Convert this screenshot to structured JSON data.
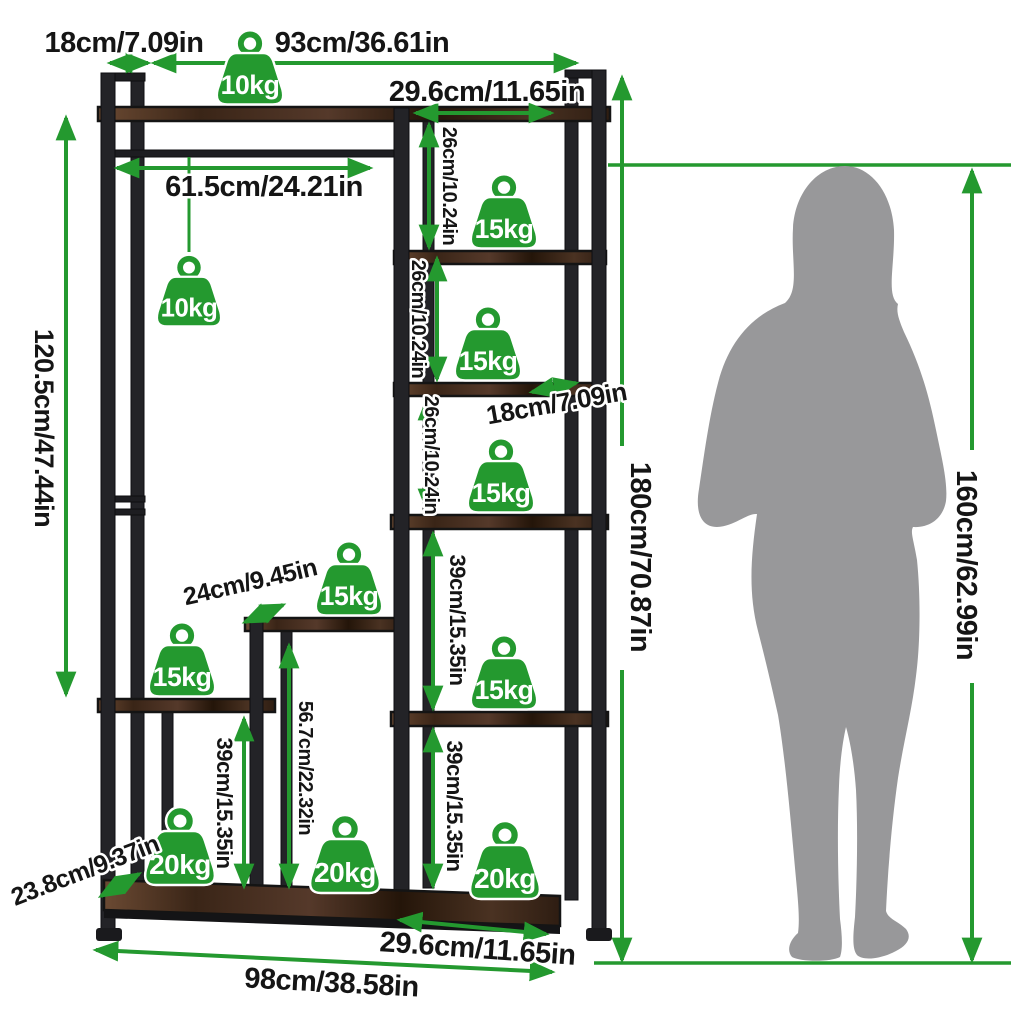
{
  "diagram": {
    "colors": {
      "accent_green": "#24992f",
      "frame_metal": "#232327",
      "shelf_wood": "#4a3322",
      "silhouette_gray": "#98989a",
      "label_text": "#151515",
      "background": "#ffffff"
    },
    "dims": {
      "top_side_width": "18cm/7.09in",
      "top_main_width": "93cm/36.61in",
      "top_shelf_depth": "29.6cm/11.65in",
      "hanging_rod_length": "61.5cm/24.21in",
      "hanging_area_height": "120.5cm/47.44in",
      "shelf_gap_top": "26cm/10.24in",
      "shelf_gap_mid": "26cm/10.24in",
      "shelf_gap_lower": "26cm/10.24in",
      "upper_shelf_depth": "18cm/7.09in",
      "total_height": "180cm/70.87in",
      "person_height": "160cm/62.99in",
      "right_gap_upper": "39cm/15.35in",
      "right_gap_lower": "39cm/15.35in",
      "left_shelf_gap": "39cm/15.35in",
      "step_column_height": "56.7cm/22.32in",
      "step_shelf_depth": "24cm/9.45in",
      "base_depth": "23.8cm/9.37in",
      "base_right_width": "29.6cm/11.65in",
      "base_total_width": "98cm/38.58in"
    },
    "capacities": {
      "top_shelf": "10kg",
      "hanging_rod": "10kg",
      "tower_shelf_1": "15kg",
      "tower_shelf_2": "15kg",
      "tower_shelf_3": "15kg",
      "tower_shelf_4": "15kg",
      "step_shelf": "15kg",
      "left_shelf": "15kg",
      "base_left": "20kg",
      "base_middle": "20kg",
      "base_right": "20kg"
    }
  }
}
